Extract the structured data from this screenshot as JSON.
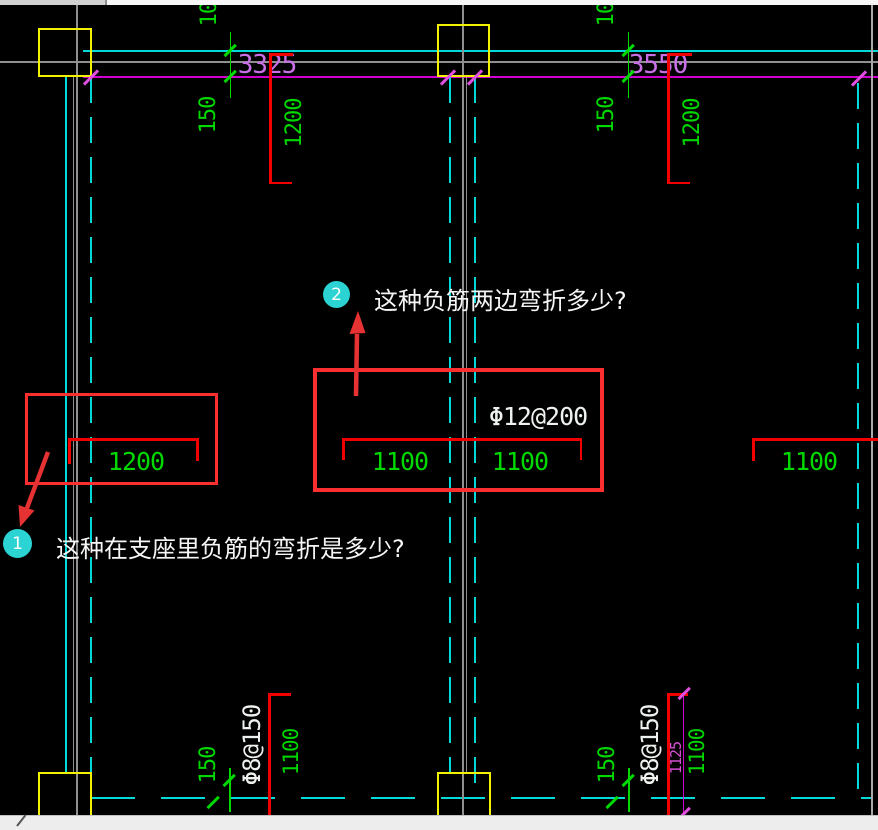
{
  "annotations": {
    "q1": {
      "badge": "1",
      "text": "这种在支座里负筋的弯折是多少?"
    },
    "q2": {
      "badge": "2",
      "text": "这种负筋两边弯折多少?"
    }
  },
  "grid_dims": {
    "span1": "3325",
    "span2": "3550"
  },
  "top_rebar": {
    "set1": {
      "offset_a": "100",
      "offset_b": "150",
      "length": "1200"
    },
    "set2": {
      "offset_a": "100",
      "offset_b": "150",
      "length": "1200"
    }
  },
  "slab_rebar": {
    "spec": "Φ12@200",
    "box1_length": "1200",
    "box2_length_left": "1100",
    "box2_length_right": "1100",
    "right_length": "1100"
  },
  "bottom_rebar": {
    "set1": {
      "offset": "150",
      "spec": "Φ8@150",
      "length": "1100"
    },
    "set2": {
      "offset": "150",
      "spec": "Φ8@150",
      "length": "1100",
      "dim": "1125"
    }
  },
  "colors": {
    "background": "#000000",
    "dimension_text_green": "#00d900",
    "grid_cyan": "#00d9d9",
    "axis_magenta": "#cf00cf",
    "axis_label_violet": "#c96fe8",
    "column_yellow": "#f2f200",
    "rebar_red": "#f20000",
    "annotation_red": "#fb2f2f",
    "beam_gray": "#8f8f8f",
    "callout_badge_cyan": "#2bd3d3",
    "label_white": "#f5f5f5"
  }
}
